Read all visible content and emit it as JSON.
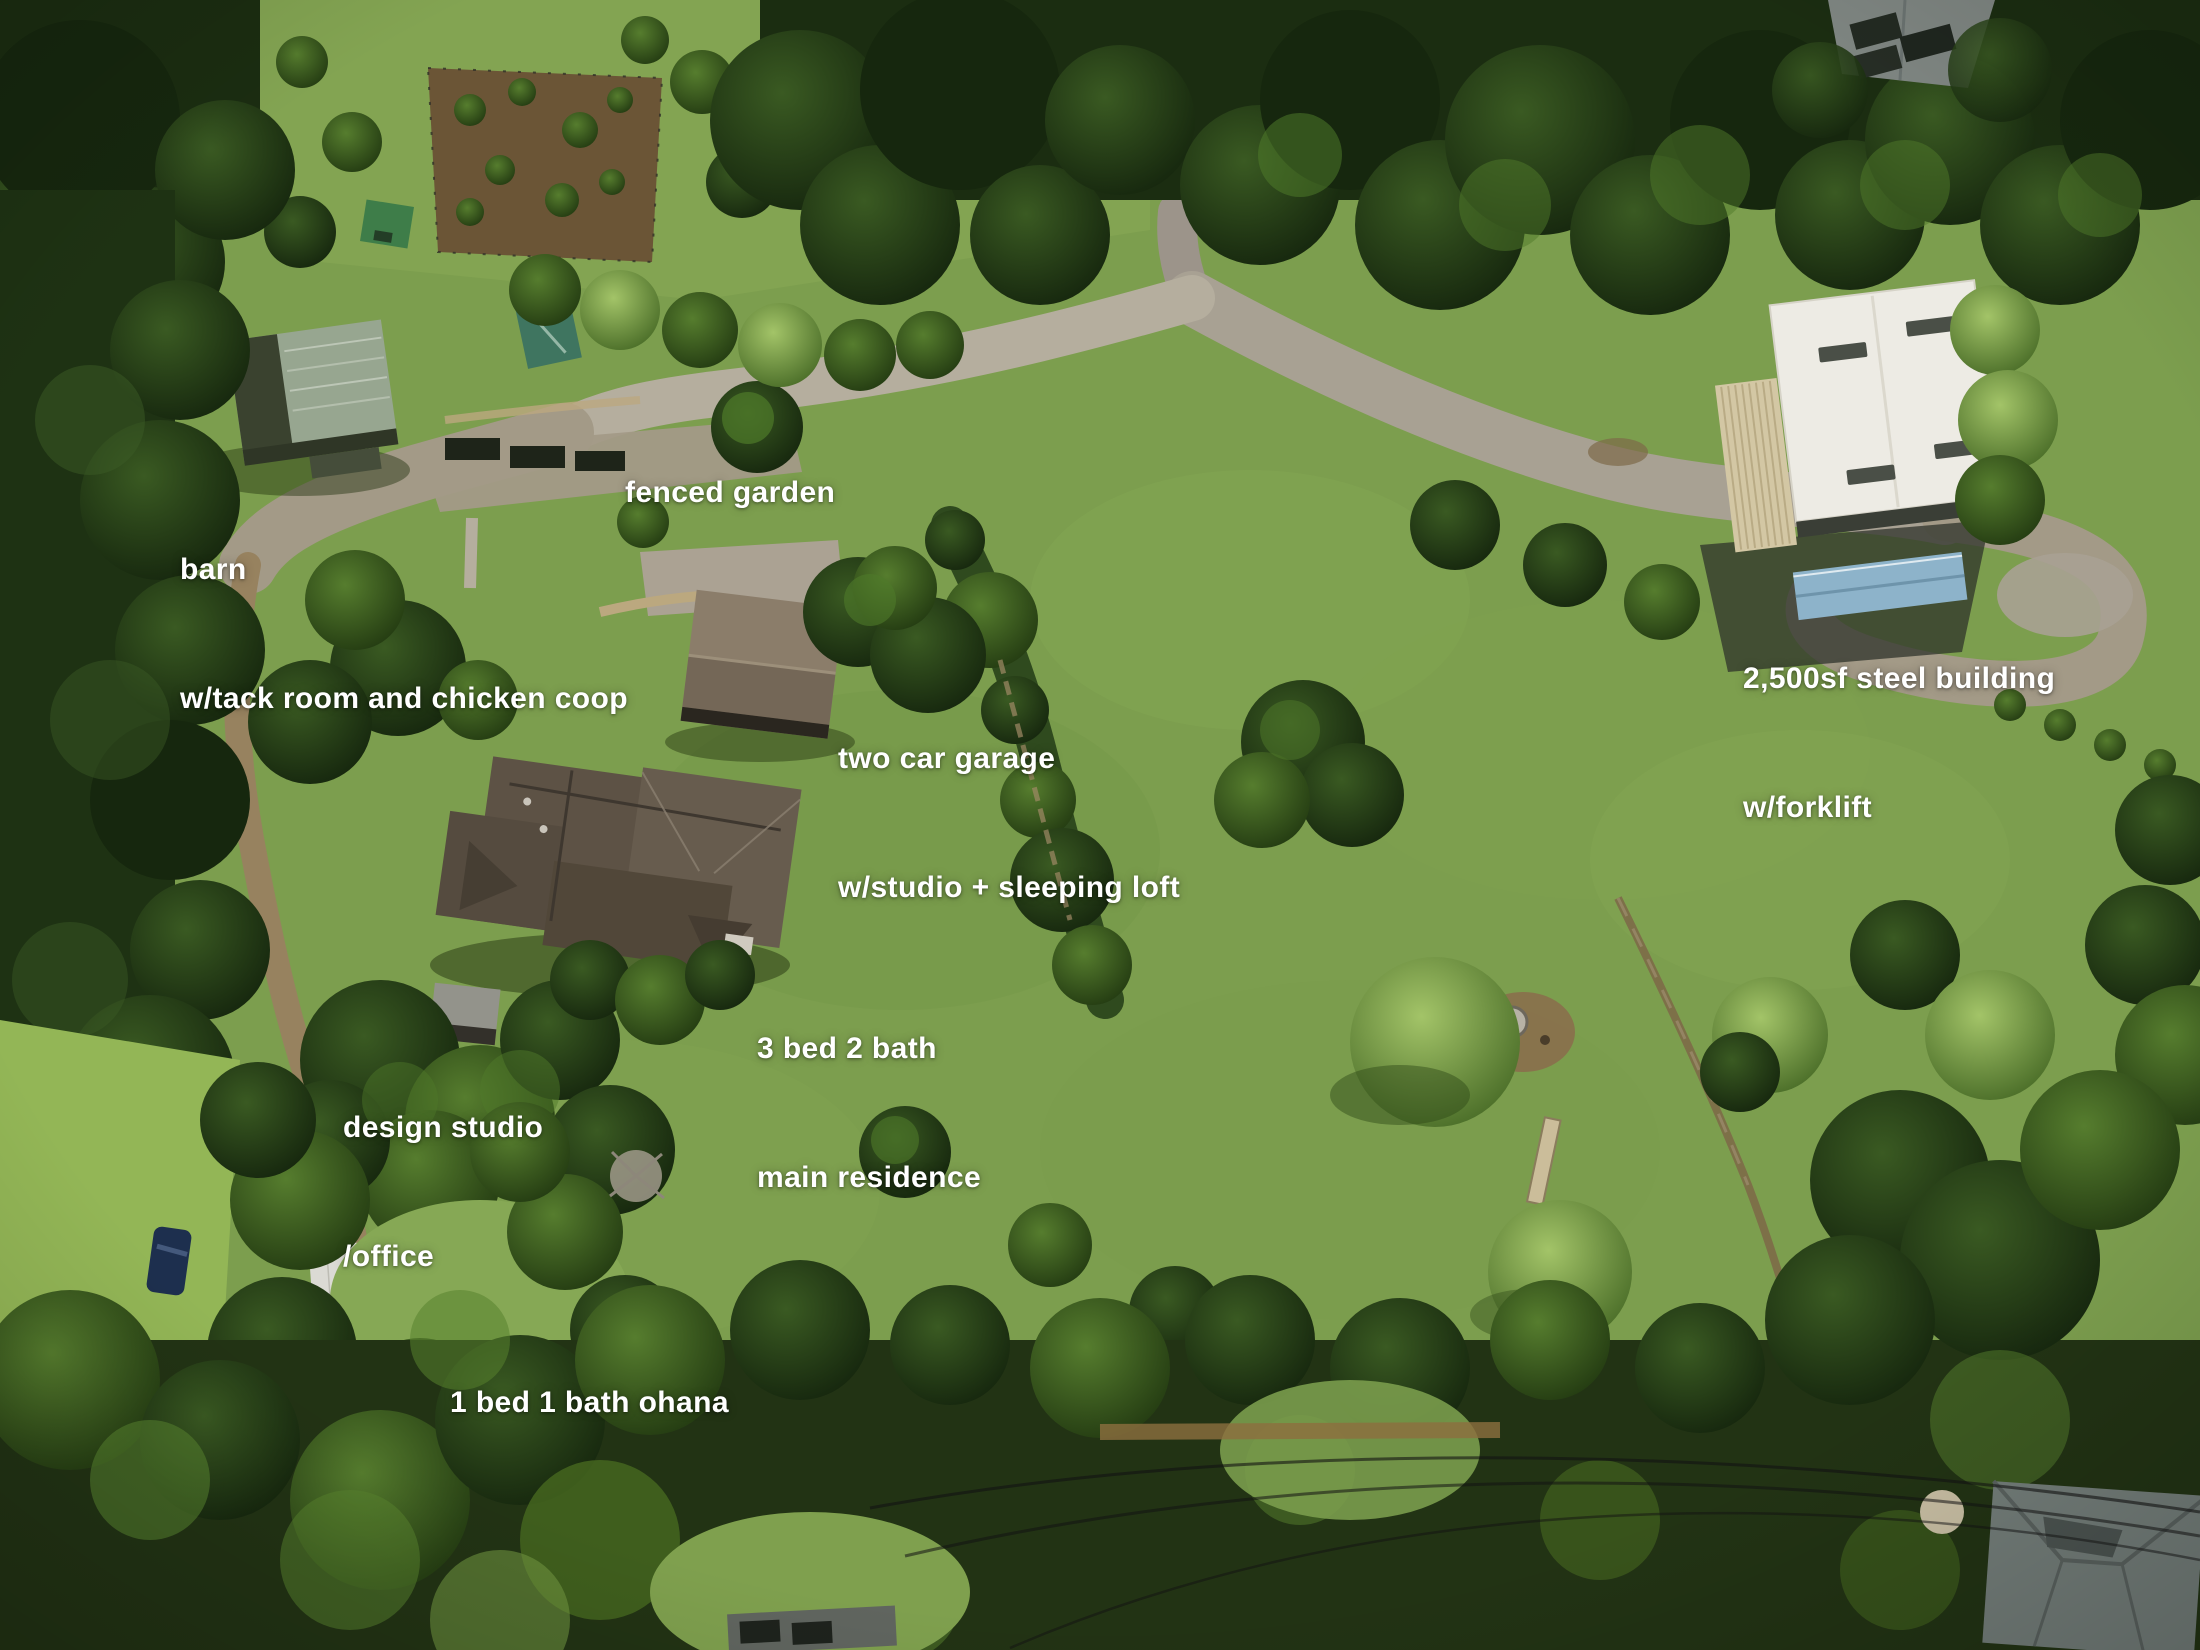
{
  "photo": {
    "kind": "aerial drone photograph",
    "subject": "rural property with labeled homes, outbuildings, lawns, gardens, tree lines and driveways",
    "annotation_color": "#ffffff"
  },
  "labels": {
    "fenced_garden": {
      "line1": "fenced garden"
    },
    "barn": {
      "line1": "barn",
      "line2": "w/tack room and chicken coop"
    },
    "steel_building": {
      "line1": "2,500sf steel building",
      "line2": "w/forklift"
    },
    "garage": {
      "line1": "two car garage",
      "line2": "w/studio + sleeping loft"
    },
    "main_residence": {
      "line1": "3 bed 2 bath",
      "line2": "main residence"
    },
    "design_studio": {
      "line1": "design studio",
      "line2": "/office"
    },
    "ohana": {
      "line1": "1 bed 1 bath ohana"
    }
  },
  "colors": {
    "lawn": "#7c9e4e",
    "lawn_bright": "#93b656",
    "tree_dark": "#1c2e12",
    "tree_mid": "#3c5c26",
    "tree_light": "#6f9440",
    "driveway_concrete": "#b5ae9e",
    "driveway_gravel": "#a39a87",
    "dirt_road": "#97825f",
    "main_house_roof": "#5d5245",
    "garage_roof": "#8b7d6a",
    "barn_roof": "#97a690",
    "ohana_roof": "#dbdad4",
    "steel_building_roof": "#edebe4",
    "steel_awning": "#d3c7a4",
    "blue_shed_roof": "#8db3ca",
    "label_text": "#ffffff"
  }
}
